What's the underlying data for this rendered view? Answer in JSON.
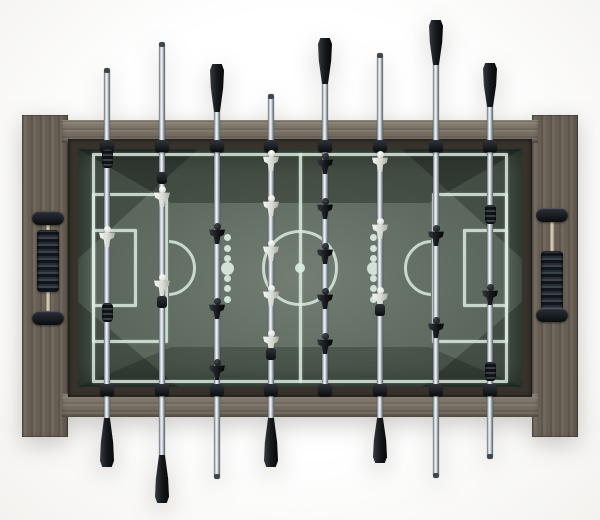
{
  "meta": {
    "subject": "foosball-table-top-view-product-photo",
    "background_color": "#ffffff",
    "visible_text": "none"
  },
  "colors": {
    "wood_rail": "#7a7063",
    "wood_panel": "#685f54",
    "bezel": "#37322b",
    "field": "#5c685d",
    "field_line": "#dcebdf",
    "handle_black": "#17191d",
    "player_white": "#eceeea",
    "player_black": "#1a1c20",
    "chrome": "#e8ecef"
  },
  "frame": {
    "panel_left": {
      "x": 22,
      "y": 115,
      "w": 46,
      "h": 322
    },
    "panel_right": {
      "x": 532,
      "y": 115,
      "w": 46,
      "h": 322
    },
    "rail_top": {
      "x": 62,
      "y": 120,
      "w": 476,
      "h": 23
    },
    "rail_bottom": {
      "x": 62,
      "y": 394,
      "w": 476,
      "h": 23
    },
    "bezel": {
      "x": 68,
      "y": 139,
      "w": 464,
      "h": 258
    }
  },
  "field": {
    "x": 78,
    "y": 149,
    "w": 444,
    "h": 238
  },
  "markings": {
    "boundary": {
      "x": 92,
      "y": 153,
      "w": 416,
      "h": 230
    },
    "center_line": {
      "x": 300,
      "y1": 153,
      "y2": 383,
      "thickness": 3
    },
    "center_circle": {
      "cx": 300,
      "cy": 268,
      "r": 38
    },
    "center_dot": {
      "cx": 300,
      "cy": 268,
      "d": 10
    },
    "penalty_box_left": {
      "x": 92,
      "y": 193,
      "w": 76,
      "h": 150
    },
    "penalty_box_right": {
      "x": 432,
      "y": 193,
      "w": 76,
      "h": 150
    },
    "goal_box_left": {
      "x": 92,
      "y": 229,
      "w": 45,
      "h": 78
    },
    "goal_box_right": {
      "x": 463,
      "y": 229,
      "w": 45,
      "h": 78
    },
    "penalty_arc_left": {
      "cx": 168,
      "cy": 268,
      "r": 28,
      "bulge": "right"
    },
    "penalty_arc_right": {
      "cx": 432,
      "cy": 268,
      "r": 28,
      "bulge": "left"
    },
    "dot_columns": {
      "xs": [
        227,
        373
      ],
      "center_y": 268,
      "big_d": 13,
      "small_d": 7,
      "small_offsets": [
        -31,
        -20,
        -10,
        10,
        20,
        31
      ]
    }
  },
  "rods": [
    {
      "id": 1,
      "x": 107,
      "team": "white",
      "role": "goalie",
      "top": {
        "end": "rod",
        "tip_y": 68
      },
      "bottom": {
        "end": "handle",
        "y": 418,
        "h": 49
      },
      "pieces": [
        {
          "kind": "bumper",
          "y": 158
        },
        {
          "kind": "player",
          "color": "white",
          "y": 236
        },
        {
          "kind": "bumper",
          "y": 312
        }
      ]
    },
    {
      "id": 2,
      "x": 162,
      "team": "white",
      "role": "defense",
      "top": {
        "end": "rod",
        "tip_y": 42
      },
      "bottom": {
        "end": "handle",
        "y": 455,
        "h": 48
      },
      "pieces": [
        {
          "kind": "bushing",
          "y": 178
        },
        {
          "kind": "player",
          "color": "white",
          "y": 196
        },
        {
          "kind": "player",
          "color": "white",
          "y": 284
        },
        {
          "kind": "bushing",
          "y": 302
        }
      ]
    },
    {
      "id": 3,
      "x": 217,
      "team": "black",
      "role": "attack",
      "top": {
        "end": "handle",
        "y": 64,
        "h": 48
      },
      "bottom": {
        "end": "rod",
        "tip_y": 479
      },
      "pieces": [
        {
          "kind": "player",
          "color": "black",
          "y": 233
        },
        {
          "kind": "player",
          "color": "black",
          "y": 308
        },
        {
          "kind": "player",
          "color": "black",
          "y": 369
        }
      ]
    },
    {
      "id": 4,
      "x": 271,
      "team": "white",
      "role": "midfield",
      "top": {
        "end": "rod",
        "tip_y": 94
      },
      "bottom": {
        "end": "handle",
        "y": 418,
        "h": 49
      },
      "pieces": [
        {
          "kind": "player",
          "color": "white",
          "y": 160
        },
        {
          "kind": "player",
          "color": "white",
          "y": 205
        },
        {
          "kind": "player",
          "color": "white",
          "y": 250
        },
        {
          "kind": "player",
          "color": "white",
          "y": 295
        },
        {
          "kind": "player",
          "color": "white",
          "y": 340
        },
        {
          "kind": "bushing",
          "y": 354
        }
      ]
    },
    {
      "id": 5,
      "x": 325,
      "team": "black",
      "role": "midfield",
      "top": {
        "end": "handle",
        "y": 38,
        "h": 46
      },
      "bottom": {
        "end": "none"
      },
      "pieces": [
        {
          "kind": "player",
          "color": "black",
          "y": 163
        },
        {
          "kind": "player",
          "color": "black",
          "y": 208
        },
        {
          "kind": "player",
          "color": "black",
          "y": 253
        },
        {
          "kind": "player",
          "color": "black",
          "y": 298
        },
        {
          "kind": "player",
          "color": "black",
          "y": 343
        }
      ]
    },
    {
      "id": 6,
      "x": 380,
      "team": "white",
      "role": "attack",
      "top": {
        "end": "rod",
        "tip_y": 53
      },
      "bottom": {
        "end": "handle",
        "y": 418,
        "h": 45
      },
      "pieces": [
        {
          "kind": "player",
          "color": "white",
          "y": 161
        },
        {
          "kind": "player",
          "color": "white",
          "y": 228
        },
        {
          "kind": "player",
          "color": "white",
          "y": 297
        },
        {
          "kind": "bushing",
          "y": 310
        }
      ]
    },
    {
      "id": 7,
      "x": 436,
      "team": "black",
      "role": "defense",
      "top": {
        "end": "handle",
        "y": 20,
        "h": 45
      },
      "bottom": {
        "end": "rod",
        "tip_y": 478
      },
      "pieces": [
        {
          "kind": "player",
          "color": "black",
          "y": 235
        },
        {
          "kind": "player",
          "color": "black",
          "y": 327
        }
      ]
    },
    {
      "id": 8,
      "x": 490,
      "team": "black",
      "role": "goalie",
      "top": {
        "end": "handle",
        "y": 63,
        "h": 44
      },
      "bottom": {
        "end": "rod",
        "tip_y": 459
      },
      "pieces": [
        {
          "kind": "bumper",
          "y": 214
        },
        {
          "kind": "player",
          "color": "black",
          "y": 294
        },
        {
          "kind": "bumper",
          "y": 371
        }
      ]
    }
  ],
  "rod_geometry": {
    "field_top": 140,
    "field_bottom": 396,
    "bearing_top_cy": 146,
    "bearing_bottom_cy": 390
  },
  "counters": {
    "left": {
      "cx": 48,
      "bracket_top_cy": 218,
      "bracket_bottom_cy": 318,
      "beads_top": 230,
      "beads_h": 62
    },
    "right": {
      "cx": 552,
      "bracket_top_cy": 215,
      "bracket_bottom_cy": 315,
      "beads_top": 251,
      "beads_h": 60
    }
  }
}
